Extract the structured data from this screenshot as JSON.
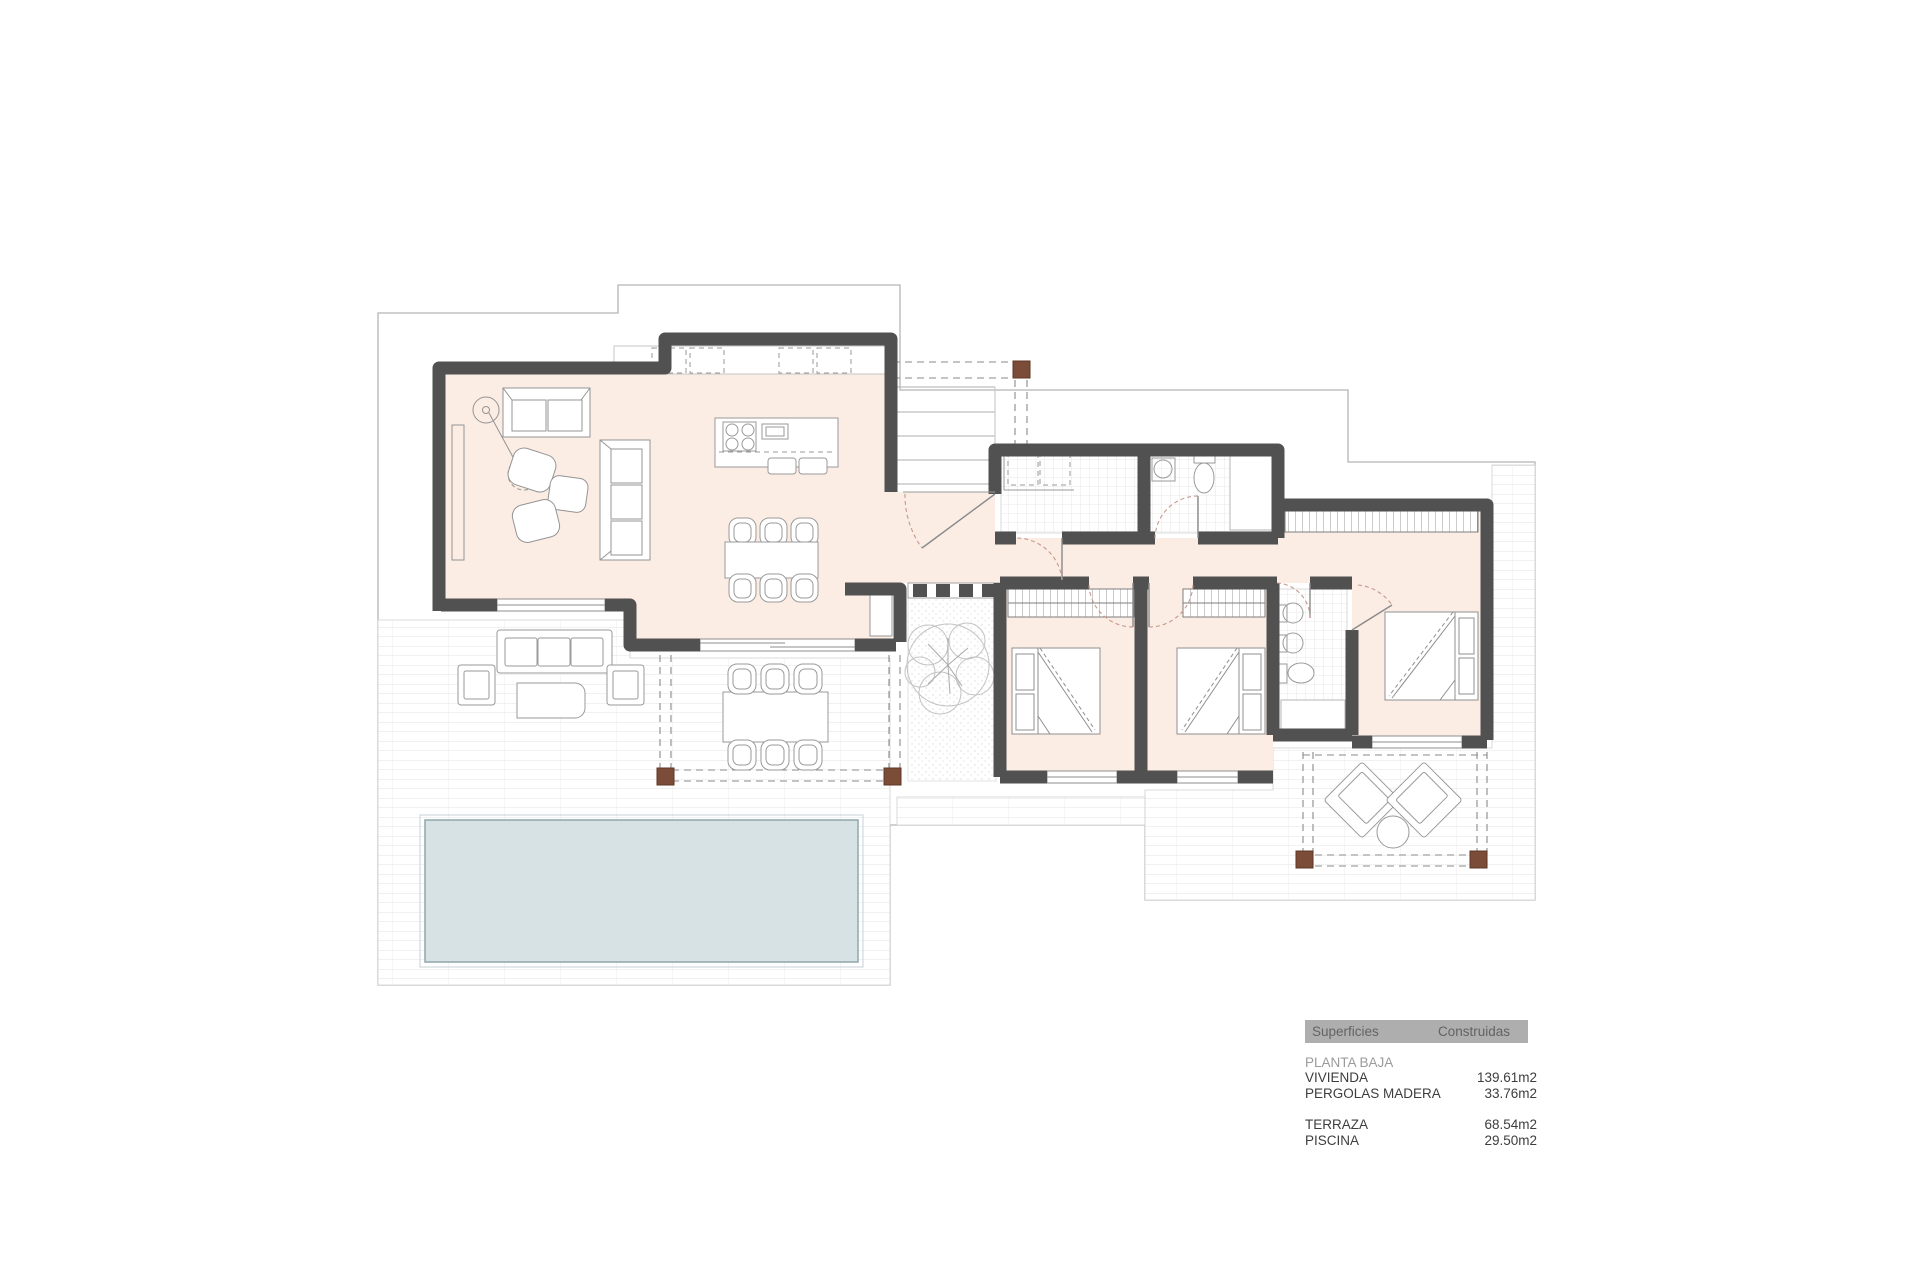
{
  "document": {
    "kind": "architectural floor plan",
    "floor": "ground floor (planta baja) of a villa with pool, terraces and wood pergolas"
  },
  "legend": {
    "header": {
      "col1": "Superficies",
      "col2": "Construidas"
    },
    "section_title": "PLANTA BAJA",
    "rows": [
      {
        "label": "VIVIENDA",
        "value": "139.61m2"
      },
      {
        "label": "PERGOLAS MADERA",
        "value": "33.76m2"
      },
      {
        "label": "TERRAZA",
        "value": "68.54m2"
      },
      {
        "label": "PISCINA",
        "value": "29.50m2"
      }
    ]
  },
  "colors": {
    "wall": "#515151",
    "room_fill": "#fbece4",
    "pool_fill": "#d6e2e4",
    "pool_border": "#95abaf",
    "terrace_line": "#e3e3e3",
    "boundary_line": "#b5b5b5",
    "pergola_post": "#7b4d38",
    "door_arc": "#c6998b",
    "furniture_line": "#909090",
    "legend_header_bg": "#aeaeae"
  }
}
